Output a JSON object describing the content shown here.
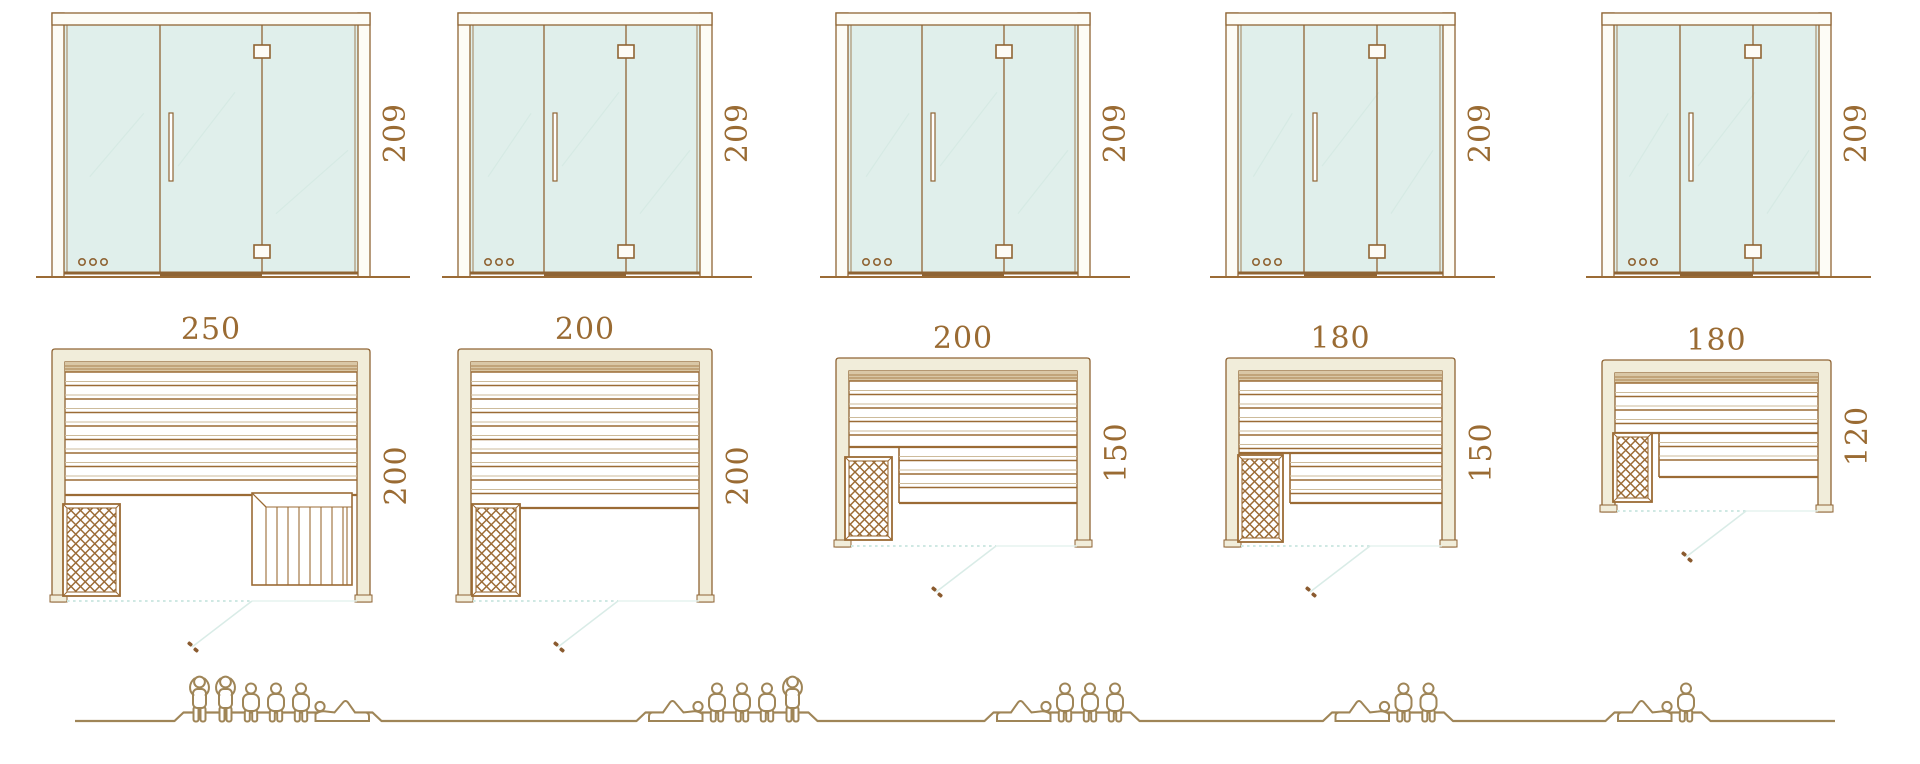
{
  "diagram": {
    "kind": "sauna-size-comparison",
    "rows": [
      "front-elevation",
      "floor-plan",
      "capacity-people"
    ],
    "model_count": 5
  },
  "colors": {
    "outline_brown": "#8f6434",
    "slat_brown": "#9b6b35",
    "slat_light": "#cdbb9b",
    "frame_cream": "#f1edda",
    "frame_white": "#fdfcf6",
    "backrest_tan": "#d9c7a6",
    "glass_mint": "#e0efeb",
    "door_swing": "#cfe8e3",
    "people_tan": "#9f8557",
    "dimension_text": "#9a6b33"
  },
  "models": [
    {
      "name": "sauna-250x200",
      "width_label": "250",
      "depth_label": "200",
      "height_label": "209",
      "width_cm": 250,
      "depth_cm": 200,
      "height_cm": 209,
      "capacity": 6,
      "people_poses": [
        "standing",
        "standing",
        "sitting",
        "sitting",
        "sitting",
        "reclining-right"
      ],
      "features": {
        "heater": "bottom-left",
        "step_bench": true,
        "lower_bench": false
      }
    },
    {
      "name": "sauna-200x200",
      "width_label": "200",
      "depth_label": "200",
      "height_label": "209",
      "width_cm": 200,
      "depth_cm": 200,
      "height_cm": 209,
      "capacity": 5,
      "people_poses": [
        "reclining-left",
        "sitting",
        "sitting",
        "sitting",
        "standing"
      ],
      "features": {
        "heater": "bottom-left",
        "step_bench": false,
        "lower_bench": false
      }
    },
    {
      "name": "sauna-200x150",
      "width_label": "200",
      "depth_label": "150",
      "height_label": "209",
      "width_cm": 200,
      "depth_cm": 150,
      "height_cm": 209,
      "capacity": 4,
      "people_poses": [
        "reclining-left",
        "sitting",
        "sitting",
        "sitting"
      ],
      "features": {
        "heater": "bottom-left",
        "step_bench": false,
        "lower_bench": true
      }
    },
    {
      "name": "sauna-180x150",
      "width_label": "180",
      "depth_label": "150",
      "height_label": "209",
      "width_cm": 180,
      "depth_cm": 150,
      "height_cm": 209,
      "capacity": 3,
      "people_poses": [
        "reclining-left",
        "sitting",
        "sitting"
      ],
      "features": {
        "heater": "bottom-left",
        "step_bench": false,
        "lower_bench": true
      }
    },
    {
      "name": "sauna-180x120",
      "width_label": "180",
      "depth_label": "120",
      "height_label": "209",
      "width_cm": 180,
      "depth_cm": 120,
      "height_cm": 209,
      "capacity": 2,
      "people_poses": [
        "reclining-left",
        "sitting"
      ],
      "features": {
        "heater": "bottom-left",
        "step_bench": false,
        "lower_bench": true
      }
    }
  ]
}
